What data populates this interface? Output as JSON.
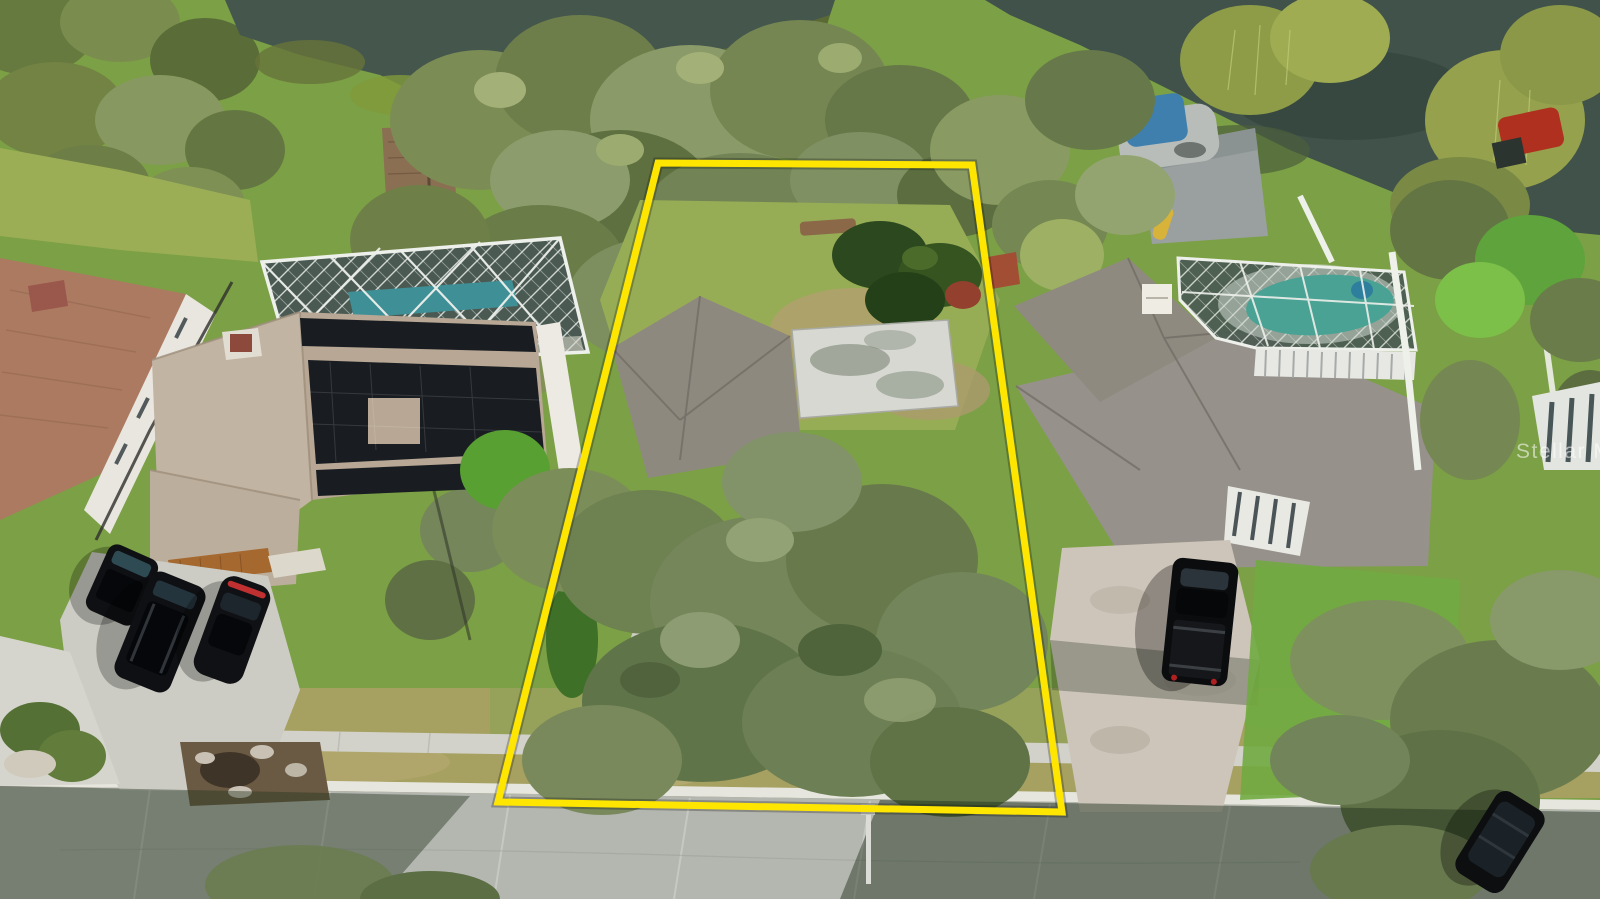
{
  "photo": {
    "kind": "aerial-drone-photo",
    "subject": "residential waterfront lot outlined in yellow, suburban street with neighboring homes, pools and lake",
    "width_px": 1600,
    "height_px": 899
  },
  "watermark": {
    "text": "Stellar MLS",
    "color": "rgba(255,255,255,0.55)"
  },
  "boundary": {
    "points_attr": "658,163 972,165 1062,812 498,802",
    "color": "#ffe600",
    "stroke_width": 7
  },
  "colors": {
    "water_left": "#45574d",
    "water_right": "#40524a",
    "algae_channel": "#5f6c31",
    "pool_left": "#3e8f96",
    "pool_right": "#49a293",
    "boat_canopy": "#3f7fae",
    "kayak": "#d8b33a",
    "red_boat": "#b03020",
    "dock_wood": "#8a6f52",
    "lawn": "#7ca045",
    "dry_grass": "#a6a061",
    "subject_house_roof": "#8e897f",
    "carport_roof": "#d7d8d2",
    "left_house_roof": "#ab7a61",
    "solar_house_roof": "#b7a794",
    "solar_panels": "#191d22",
    "right_house_roof": "#96918a",
    "paver_driveway": "#cdc5ba",
    "concrete": "#ccccc4",
    "sidewalk": "#d2d2ca",
    "curb": "#e6e6de",
    "road": "#b4b6b0",
    "vehicle_black": "#0e1013"
  }
}
